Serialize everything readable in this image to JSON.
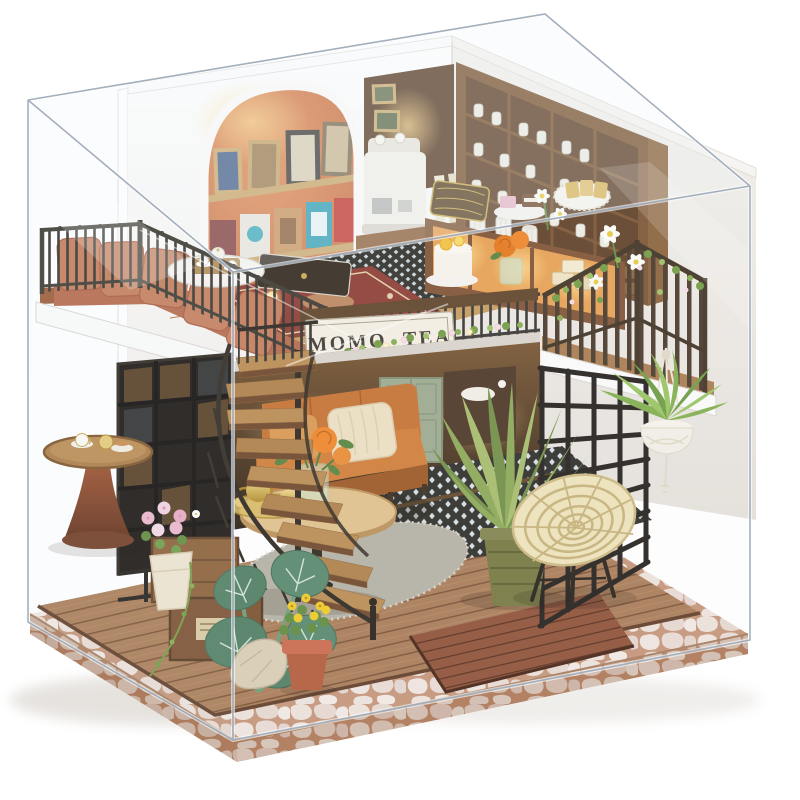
{
  "scene": {
    "alt": "Miniature DIY dollhouse tea shop diorama displayed inside a clear acrylic dust cover",
    "storefront_sign": "MOMO TEA"
  },
  "palette": {
    "background": "#ffffff",
    "acrylic_edge": "#9aa7b6",
    "wall_white": "#f6f4f1",
    "alcove_orange": "#c9693c",
    "wood_dark": "#6b4527",
    "wood_mid": "#a87947",
    "wood_light": "#c99e63",
    "metal_black": "#2f2d28",
    "sofa_terracotta": "#bf7050",
    "sofa_orange": "#c4702e",
    "rose_orange": "#e87a22",
    "leaf_green": "#6f9a3f",
    "fern_green": "#8aa653",
    "rattan": "#eee2b8",
    "rug_red": "#8c3a30",
    "rug_grey": "#b3afa2",
    "door_sage": "#9aa88b",
    "tile_dark": "#2d2d28",
    "cobblestone": "#e9ddd6",
    "grout": "#c39376",
    "sign_background": "#f4efe3",
    "sign_text_color": "#3f3a31",
    "warm_light": "#ffd98a"
  }
}
